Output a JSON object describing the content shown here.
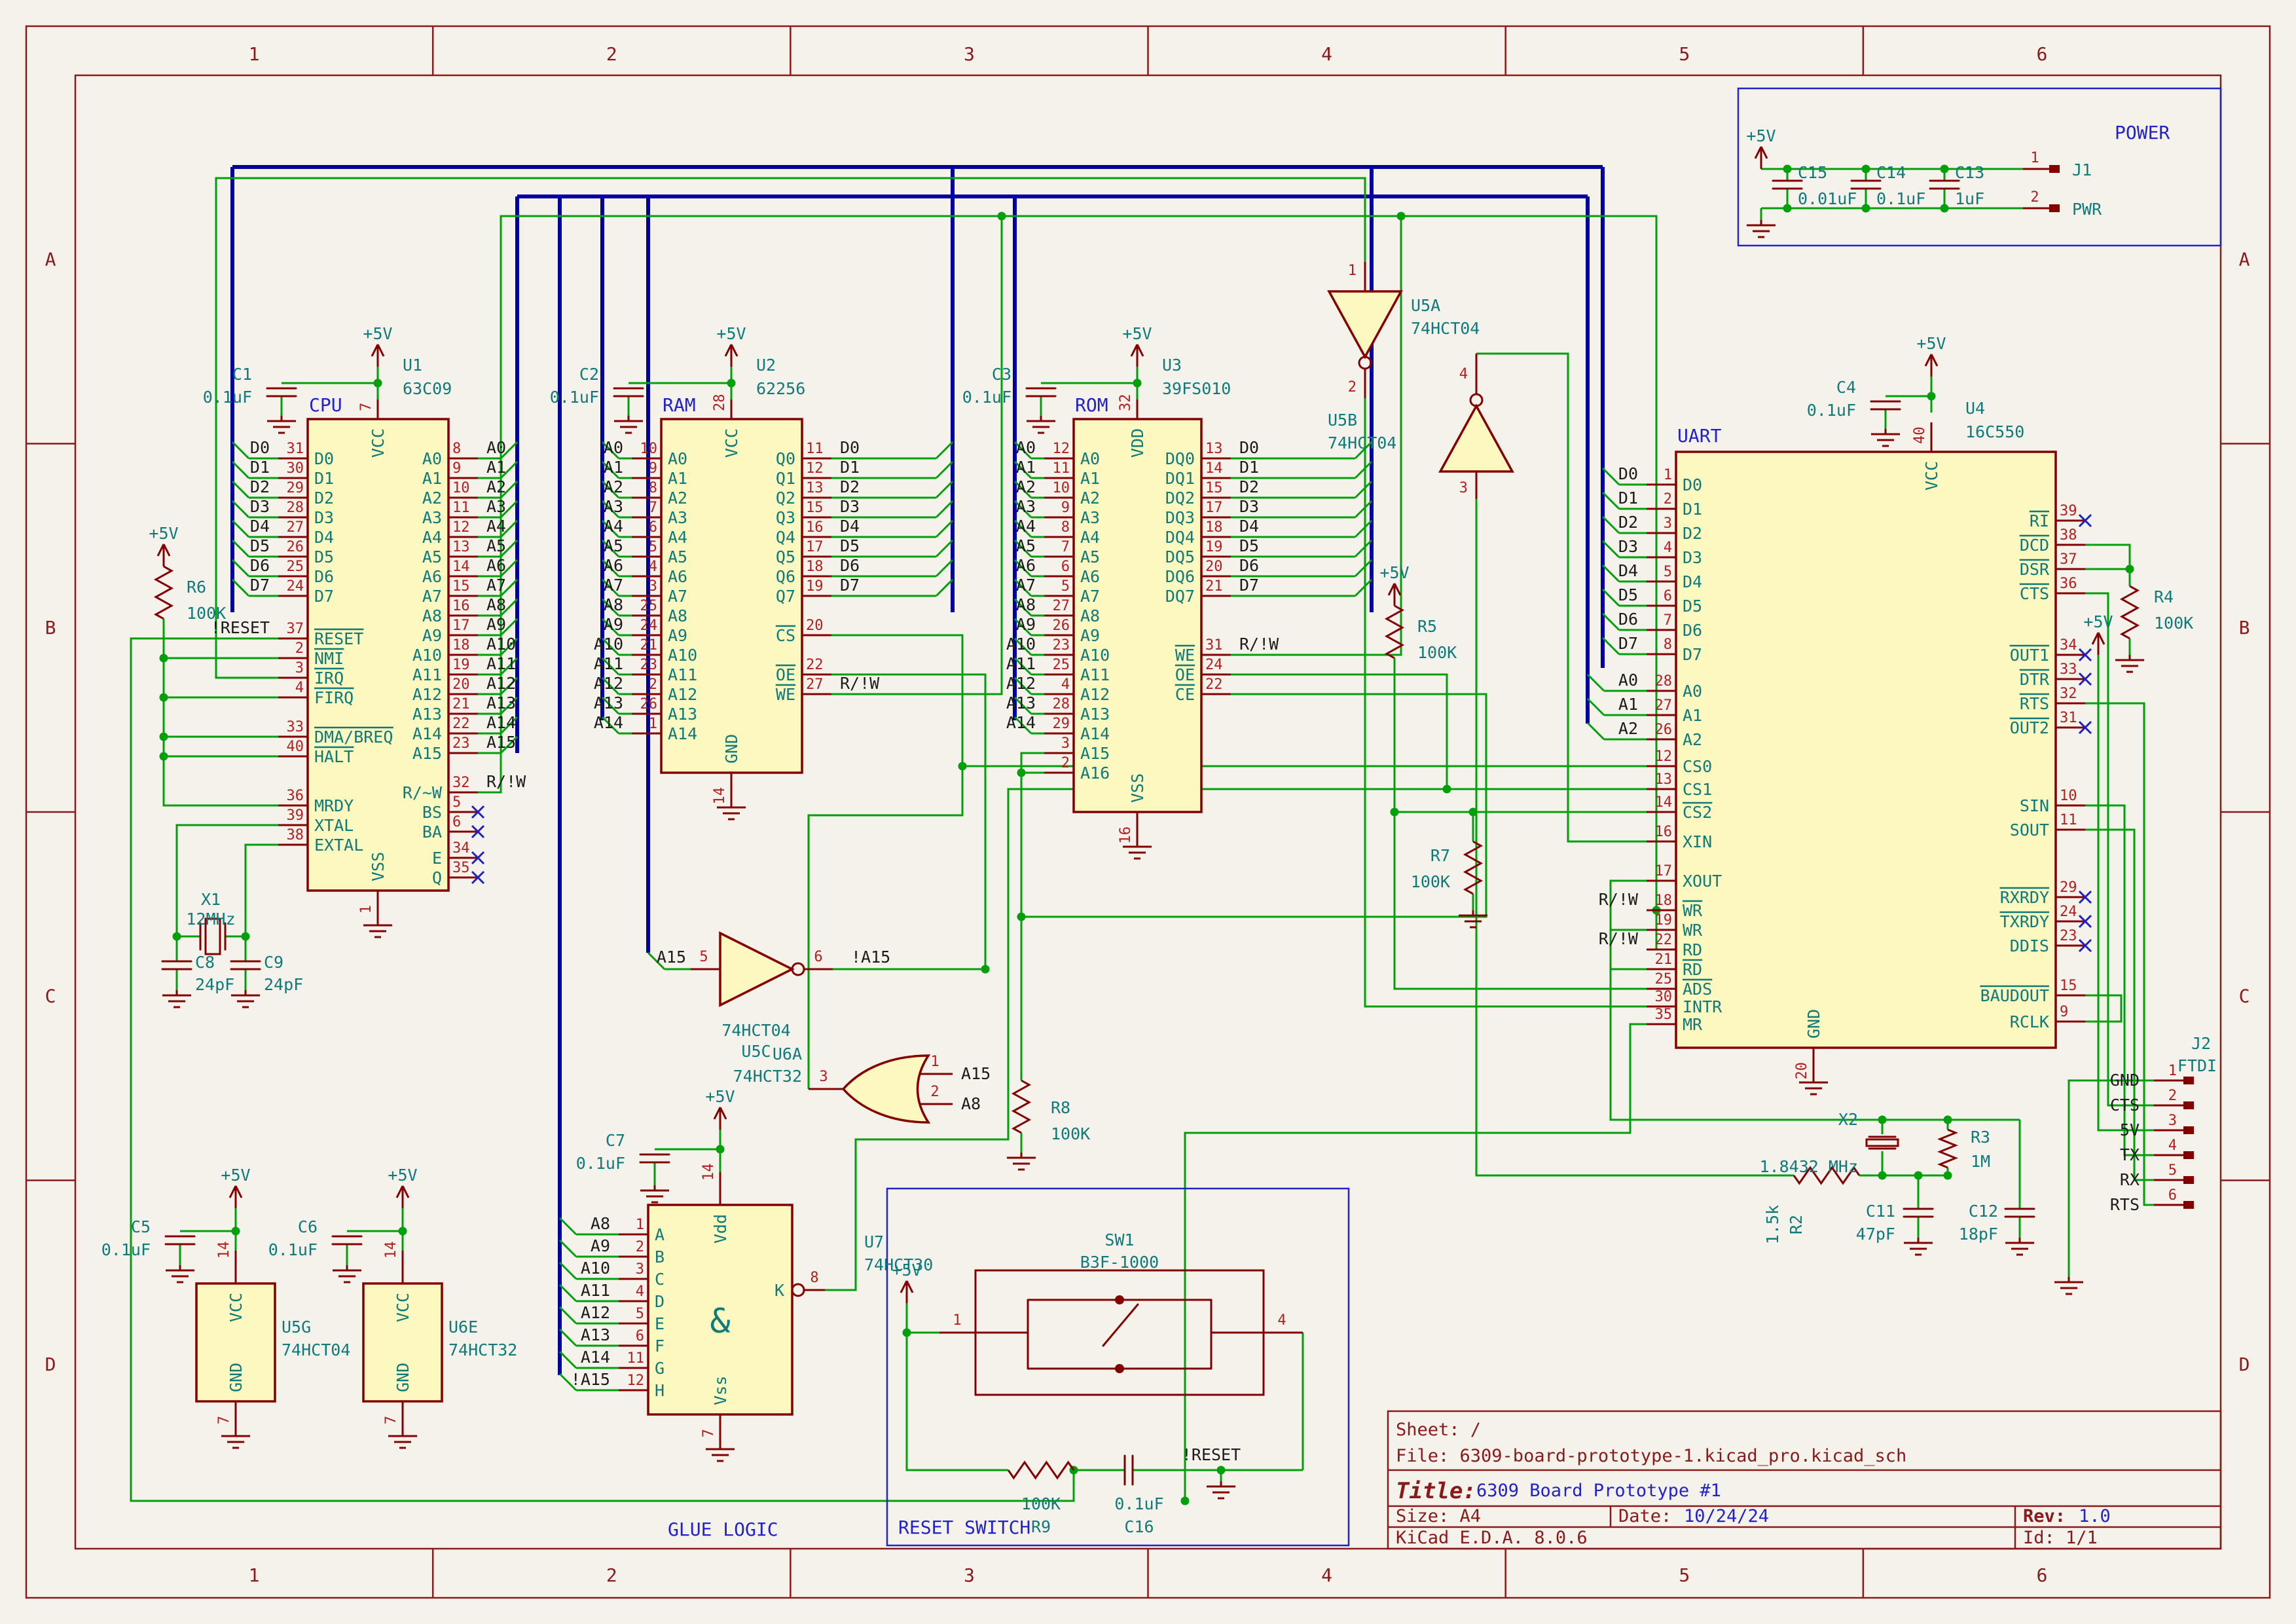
{
  "sheet": {
    "frame_columns": [
      "1",
      "2",
      "3",
      "4",
      "5",
      "6"
    ],
    "frame_rows": [
      "A",
      "B",
      "C",
      "D"
    ]
  },
  "title_block": {
    "sheet": "Sheet: /",
    "file": "File: 6309-board-prototype-1.kicad_pro.kicad_sch",
    "title_label": "Title:",
    "title": "6309 Board Prototype #1",
    "size": "Size: A4",
    "date_label": "Date:",
    "date": "10/24/24",
    "rev_label": "Rev:",
    "rev": "1.0",
    "tool": "KiCad E.D.A. 8.0.6",
    "id": "Id: 1/1"
  },
  "section_labels": {
    "cpu": "CPU",
    "ram": "RAM",
    "rom": "ROM",
    "uart": "UART",
    "power": "POWER",
    "glue_logic": "GLUE LOGIC",
    "reset_switch": "RESET SWITCH"
  },
  "power_net": "+5V",
  "ics": {
    "U1": {
      "ref": "U1",
      "value": "63C09",
      "top": {
        "n": "7",
        "name": "VCC"
      },
      "bottom": {
        "n": "1",
        "name": "VSS"
      },
      "left": [
        [
          "31",
          "D0",
          "D0"
        ],
        [
          "30",
          "D1",
          "D1"
        ],
        [
          "29",
          "D2",
          "D2"
        ],
        [
          "28",
          "D3",
          "D3"
        ],
        [
          "27",
          "D4",
          "D4"
        ],
        [
          "26",
          "D5",
          "D5"
        ],
        [
          "25",
          "D6",
          "D6"
        ],
        [
          "24",
          "D7",
          "D7"
        ],
        [
          "37",
          "~RESET",
          "!RESET"
        ],
        [
          "2",
          "~NMI",
          ""
        ],
        [
          "3",
          "~IRQ",
          ""
        ],
        [
          "4",
          "~FIRQ",
          ""
        ],
        [
          "33",
          "~DMA/BREQ",
          ""
        ],
        [
          "40",
          "~HALT",
          ""
        ],
        [
          "36",
          "MRDY",
          ""
        ],
        [
          "39",
          "XTAL",
          ""
        ],
        [
          "38",
          "EXTAL",
          ""
        ]
      ],
      "right": [
        [
          "8",
          "A0",
          "A0"
        ],
        [
          "9",
          "A1",
          "A1"
        ],
        [
          "10",
          "A2",
          "A2"
        ],
        [
          "11",
          "A3",
          "A3"
        ],
        [
          "12",
          "A4",
          "A4"
        ],
        [
          "13",
          "A5",
          "A5"
        ],
        [
          "14",
          "A6",
          "A6"
        ],
        [
          "15",
          "A7",
          "A7"
        ],
        [
          "16",
          "A8",
          "A8"
        ],
        [
          "17",
          "A9",
          "A9"
        ],
        [
          "18",
          "A10",
          "A10"
        ],
        [
          "19",
          "A11",
          "A11"
        ],
        [
          "20",
          "A12",
          "A12"
        ],
        [
          "21",
          "A13",
          "A13"
        ],
        [
          "22",
          "A14",
          "A14"
        ],
        [
          "23",
          "A15",
          "A15"
        ],
        [
          "32",
          "R/~W",
          "R/!W"
        ],
        [
          "5",
          "BS",
          "",
          "x"
        ],
        [
          "6",
          "BA",
          "",
          "x"
        ],
        [
          "34",
          "E",
          "",
          "x"
        ],
        [
          "35",
          "Q",
          "",
          "x"
        ]
      ]
    },
    "U2": {
      "ref": "U2",
      "value": "62256",
      "top": {
        "n": "28",
        "name": "VCC"
      },
      "bottom": {
        "n": "14",
        "name": "GND"
      },
      "left": [
        [
          "10",
          "A0",
          "A0"
        ],
        [
          "9",
          "A1",
          "A1"
        ],
        [
          "8",
          "A2",
          "A2"
        ],
        [
          "7",
          "A3",
          "A3"
        ],
        [
          "6",
          "A4",
          "A4"
        ],
        [
          "5",
          "A5",
          "A5"
        ],
        [
          "4",
          "A6",
          "A6"
        ],
        [
          "3",
          "A7",
          "A7"
        ],
        [
          "25",
          "A8",
          "A8"
        ],
        [
          "24",
          "A9",
          "A9"
        ],
        [
          "21",
          "A10",
          "A10"
        ],
        [
          "23",
          "A11",
          "A11"
        ],
        [
          "2",
          "A12",
          "A12"
        ],
        [
          "26",
          "A13",
          "A13"
        ],
        [
          "1",
          "A14",
          "A14"
        ]
      ],
      "right": [
        [
          "11",
          "Q0",
          "D0"
        ],
        [
          "12",
          "Q1",
          "D1"
        ],
        [
          "13",
          "Q2",
          "D2"
        ],
        [
          "15",
          "Q3",
          "D3"
        ],
        [
          "16",
          "Q4",
          "D4"
        ],
        [
          "17",
          "Q5",
          "D5"
        ],
        [
          "18",
          "Q6",
          "D6"
        ],
        [
          "19",
          "Q7",
          "D7"
        ],
        [
          "20",
          "~CS",
          ""
        ],
        [
          "22",
          "~OE",
          ""
        ],
        [
          "27",
          "~WE",
          "R/!W"
        ]
      ]
    },
    "U3": {
      "ref": "U3",
      "value": "39FS010",
      "top": {
        "n": "32",
        "name": "VDD"
      },
      "bottom": {
        "n": "16",
        "name": "VSS"
      },
      "left": [
        [
          "12",
          "A0",
          "A0"
        ],
        [
          "11",
          "A1",
          "A1"
        ],
        [
          "10",
          "A2",
          "A2"
        ],
        [
          "9",
          "A3",
          "A3"
        ],
        [
          "8",
          "A4",
          "A4"
        ],
        [
          "7",
          "A5",
          "A5"
        ],
        [
          "6",
          "A6",
          "A6"
        ],
        [
          "5",
          "A7",
          "A7"
        ],
        [
          "27",
          "A8",
          "A8"
        ],
        [
          "26",
          "A9",
          "A9"
        ],
        [
          "23",
          "A10",
          "A10"
        ],
        [
          "25",
          "A11",
          "A11"
        ],
        [
          "4",
          "A12",
          "A12"
        ],
        [
          "28",
          "A13",
          "A13"
        ],
        [
          "29",
          "A14",
          "A14"
        ],
        [
          "3",
          "A15",
          ""
        ],
        [
          "2",
          "A16",
          ""
        ]
      ],
      "right": [
        [
          "13",
          "DQ0",
          "D0"
        ],
        [
          "14",
          "DQ1",
          "D1"
        ],
        [
          "15",
          "DQ2",
          "D2"
        ],
        [
          "17",
          "DQ3",
          "D3"
        ],
        [
          "18",
          "DQ4",
          "D4"
        ],
        [
          "19",
          "DQ5",
          "D5"
        ],
        [
          "20",
          "DQ6",
          "D6"
        ],
        [
          "21",
          "DQ7",
          "D7"
        ],
        [
          "31",
          "~WE",
          "R/!W"
        ],
        [
          "24",
          "~OE",
          ""
        ],
        [
          "22",
          "~CE",
          ""
        ]
      ]
    },
    "U4": {
      "ref": "U4",
      "value": "16C550",
      "top": {
        "n": "40",
        "name": "VCC"
      },
      "bottom": {
        "n": "20",
        "name": "GND"
      },
      "left": [
        [
          "1",
          "D0",
          "D0"
        ],
        [
          "2",
          "D1",
          "D1"
        ],
        [
          "3",
          "D2",
          "D2"
        ],
        [
          "4",
          "D3",
          "D3"
        ],
        [
          "5",
          "D4",
          "D4"
        ],
        [
          "6",
          "D5",
          "D5"
        ],
        [
          "7",
          "D6",
          "D6"
        ],
        [
          "8",
          "D7",
          "D7"
        ],
        [
          "28",
          "A0",
          "A0"
        ],
        [
          "27",
          "A1",
          "A1"
        ],
        [
          "26",
          "A2",
          "A2"
        ],
        [
          "12",
          "CS0",
          ""
        ],
        [
          "13",
          "CS1",
          ""
        ],
        [
          "14",
          "~CS2",
          ""
        ],
        [
          "16",
          "XIN",
          ""
        ],
        [
          "17",
          "XOUT",
          ""
        ],
        [
          "18",
          "~WR",
          "R/!W"
        ],
        [
          "19",
          "WR",
          ""
        ],
        [
          "22",
          "RD",
          "R/!W"
        ],
        [
          "21",
          "~RD",
          ""
        ],
        [
          "25",
          "~ADS",
          ""
        ],
        [
          "30",
          "INTR",
          ""
        ],
        [
          "35",
          "MR",
          ""
        ]
      ],
      "right": [
        [
          "39",
          "~RI",
          "",
          "x"
        ],
        [
          "38",
          "~DCD",
          ""
        ],
        [
          "37",
          "~DSR",
          ""
        ],
        [
          "36",
          "~CTS",
          ""
        ],
        [
          "34",
          "~OUT1",
          "",
          "x"
        ],
        [
          "33",
          "~DTR",
          "",
          "x"
        ],
        [
          "32",
          "~RTS",
          ""
        ],
        [
          "31",
          "~OUT2",
          "",
          "x"
        ],
        [
          "10",
          "SIN",
          ""
        ],
        [
          "11",
          "SOUT",
          ""
        ],
        [
          "29",
          "~RXRDY",
          "",
          "x"
        ],
        [
          "24",
          "~TXRDY",
          "",
          "x"
        ],
        [
          "23",
          "DDIS",
          "",
          "x"
        ],
        [
          "15",
          "~BAUDOUT",
          ""
        ],
        [
          "9",
          "RCLK",
          ""
        ]
      ]
    }
  },
  "gates": {
    "U5A": {
      "ref": "U5A",
      "value": "74HCT04",
      "in_pin": "1",
      "out_pin": "2"
    },
    "U5B": {
      "ref": "U5B",
      "value": "74HCT04",
      "in_pin": "3",
      "out_pin": "4"
    },
    "U5C": {
      "ref": "U5C",
      "value": "74HCT04",
      "in_pin": "5",
      "out_pin": "6",
      "in_label": "A15",
      "out_label": "!A15"
    },
    "U6A": {
      "ref": "U6A",
      "value": "74HCT32",
      "out_pin": "3",
      "in1_pin": "1",
      "in1_label": "A15",
      "in2_pin": "2",
      "in2_label": "A8"
    },
    "U7": {
      "ref": "U7",
      "value": "74HCT30",
      "glyph": "&",
      "out": {
        "n": "8",
        "name": "K"
      },
      "top": {
        "n": "14",
        "name": "Vdd"
      },
      "bottom": {
        "n": "7",
        "name": "Vss"
      },
      "inputs": [
        [
          "1",
          "A",
          "A8"
        ],
        [
          "2",
          "B",
          "A9"
        ],
        [
          "3",
          "C",
          "A10"
        ],
        [
          "4",
          "D",
          "A11"
        ],
        [
          "5",
          "E",
          "A12"
        ],
        [
          "6",
          "F",
          "A13"
        ],
        [
          "11",
          "G",
          "A14"
        ],
        [
          "12",
          "H",
          "!A15"
        ]
      ]
    }
  },
  "power_units": {
    "U5G": {
      "ref": "U5G",
      "value": "74HCT04",
      "top": {
        "n": "14",
        "name": "VCC"
      },
      "bottom": {
        "n": "7",
        "name": "GND"
      }
    },
    "U6E": {
      "ref": "U6E",
      "value": "74HCT32",
      "top": {
        "n": "14",
        "name": "VCC"
      },
      "bottom": {
        "n": "7",
        "name": "GND"
      }
    }
  },
  "parts": {
    "C1": {
      "ref": "C1",
      "value": "0.1uF"
    },
    "C2": {
      "ref": "C2",
      "value": "0.1uF"
    },
    "C3": {
      "ref": "C3",
      "value": "0.1uF"
    },
    "C4": {
      "ref": "C4",
      "value": "0.1uF"
    },
    "C5": {
      "ref": "C5",
      "value": "0.1uF"
    },
    "C6": {
      "ref": "C6",
      "value": "0.1uF"
    },
    "C7": {
      "ref": "C7",
      "value": "0.1uF"
    },
    "C8": {
      "ref": "C8",
      "value": "24pF"
    },
    "C9": {
      "ref": "C9",
      "value": "24pF"
    },
    "C11": {
      "ref": "C11",
      "value": "47pF"
    },
    "C12": {
      "ref": "C12",
      "value": "18pF"
    },
    "C13": {
      "ref": "C13",
      "value": "1uF"
    },
    "C14": {
      "ref": "C14",
      "value": "0.1uF"
    },
    "C15": {
      "ref": "C15",
      "value": "0.01uF"
    },
    "C16": {
      "ref": "C16",
      "value": "0.1uF"
    },
    "R2": {
      "ref": "R2",
      "value": "1.5k"
    },
    "R3": {
      "ref": "R3",
      "value": "1M"
    },
    "R4": {
      "ref": "R4",
      "value": "100K"
    },
    "R5": {
      "ref": "R5",
      "value": "100K"
    },
    "R6": {
      "ref": "R6",
      "value": "100K"
    },
    "R7": {
      "ref": "R7",
      "value": "100K"
    },
    "R8": {
      "ref": "R8",
      "value": "100K"
    },
    "R9": {
      "ref": "R9",
      "value": "100K"
    },
    "X1": {
      "ref": "X1",
      "value": "12MHz"
    },
    "X2": {
      "ref": "X2",
      "value": "1.8432 MHz"
    },
    "SW1": {
      "ref": "SW1",
      "value": "B3F-1000",
      "pins": [
        "1",
        "4"
      ]
    },
    "J1": {
      "ref": "J1",
      "value": "PWR",
      "pins": [
        "1",
        "2"
      ]
    },
    "J2": {
      "ref": "J2",
      "value": "FTDI",
      "pins": [
        [
          "1",
          "GND"
        ],
        [
          "2",
          "CTS"
        ],
        [
          "3",
          "5V"
        ],
        [
          "4",
          "TX"
        ],
        [
          "5",
          "RX"
        ],
        [
          "6",
          "RTS"
        ]
      ]
    }
  },
  "net_labels": {
    "reset": "!RESET",
    "rw": "R/!W",
    "na15": "!A15"
  }
}
